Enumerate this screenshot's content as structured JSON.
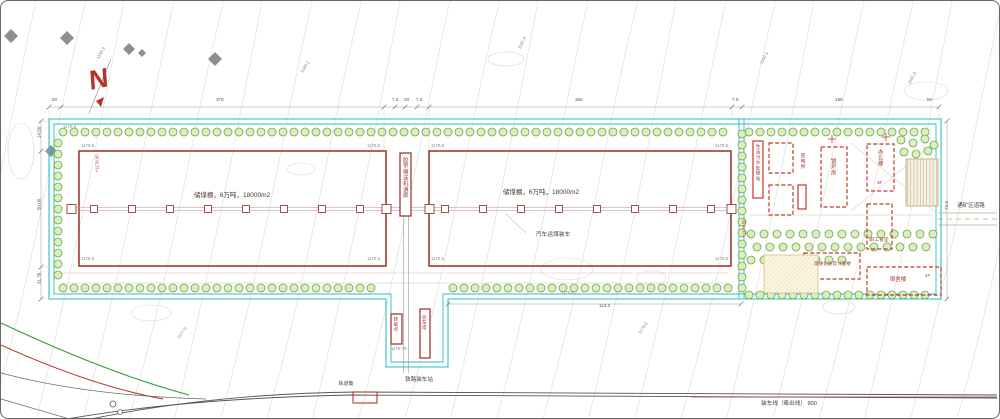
{
  "drawing": {
    "north_label": "N",
    "sheds": {
      "left_label": "储煤棚，6万吨，18000m2",
      "right_label": "储煤棚，6万吨，18000m2",
      "truck_loading_label": "汽车运煤装车",
      "conveyor_label": "胶带输送机通廊"
    },
    "loading_area": {
      "transfer_label": "转载点",
      "tower_label": "装车塔",
      "station_label": "铁路装车站",
      "track_scale_label": "轨道衡",
      "loading_line_label": "装车线（牵出线） 900"
    },
    "aux_area": {
      "sewage_label": "生活污水处理站",
      "substation_label": "变电所",
      "boiler_label": "锅炉房",
      "office_label": "办公楼",
      "office_floors": "3F",
      "canteen_label": "职工食堂",
      "dorm_label": "宿舍楼",
      "dorm_floors": "4F",
      "lab_label": "煤质化验及计量楼",
      "road_label": "通矿区道路"
    },
    "colors": {
      "boundary": "#2bbfc2",
      "building": "#9e3b32",
      "planned": "#c0392b",
      "tree_fill": "#dcedbe",
      "tree_stroke": "#69a84f",
      "contour": "#dcdcdc",
      "north": "#b5342c"
    }
  },
  "dimensions": [
    {
      "t": "50",
      "x": 51,
      "y": 97
    },
    {
      "t": "378",
      "x": 215,
      "y": 97
    },
    {
      "t": "7.0",
      "x": 391,
      "y": 97
    },
    {
      "t": "30",
      "x": 403,
      "y": 97
    },
    {
      "t": "7.0",
      "x": 415,
      "y": 97
    },
    {
      "t": "368",
      "x": 574,
      "y": 97
    },
    {
      "t": "7.0",
      "x": 731,
      "y": 97
    },
    {
      "t": "198",
      "x": 834,
      "y": 97
    },
    {
      "t": "50",
      "x": 926,
      "y": 97
    },
    {
      "t": "14.50",
      "x": 33,
      "y": 129,
      "r": -90
    },
    {
      "t": "50.00",
      "x": 33,
      "y": 201,
      "r": -90
    },
    {
      "t": "31.76",
      "x": 33,
      "y": 275,
      "r": -90
    },
    {
      "t": "74.0",
      "x": 942,
      "y": 202,
      "r": -90
    },
    {
      "t": "113.0",
      "x": 598,
      "y": 303
    }
  ],
  "elevations": [
    {
      "t": "1180.9",
      "x": 94,
      "y": 50,
      "r": -60
    },
    {
      "t": "1178.3",
      "x": 62,
      "y": 124
    },
    {
      "t": "1178.5",
      "x": 80,
      "y": 143
    },
    {
      "t": "1178.5",
      "x": 366,
      "y": 143
    },
    {
      "t": "1178.5",
      "x": 430,
      "y": 143
    },
    {
      "t": "1178.5",
      "x": 714,
      "y": 143
    },
    {
      "t": "1178.5",
      "x": 80,
      "y": 256
    },
    {
      "t": "1178.5",
      "x": 366,
      "y": 256
    },
    {
      "t": "1178.5",
      "x": 430,
      "y": 256
    },
    {
      "t": "1178.5",
      "x": 714,
      "y": 256
    },
    {
      "t": "1178.76",
      "x": 390,
      "y": 346
    },
    {
      "t": "1179.0",
      "x": 560,
      "y": 290
    },
    {
      "t": "+1178.50",
      "x": 88,
      "y": 160,
      "r": -90,
      "c": "#c0392b"
    },
    {
      "t": "+1178.50",
      "x": 735,
      "y": 225,
      "r": -90,
      "c": "#c0392b"
    },
    {
      "t": "1180.2",
      "x": 298,
      "y": 64,
      "r": -58
    },
    {
      "t": "1181.4",
      "x": 515,
      "y": 40,
      "r": -62
    },
    {
      "t": "1182.1",
      "x": 757,
      "y": 55,
      "r": -62
    },
    {
      "t": "1179.6",
      "x": 636,
      "y": 325,
      "r": -55
    },
    {
      "t": "1177.9",
      "x": 175,
      "y": 330,
      "r": -55
    },
    {
      "t": "1181.0",
      "x": 905,
      "y": 75,
      "r": -62
    }
  ]
}
